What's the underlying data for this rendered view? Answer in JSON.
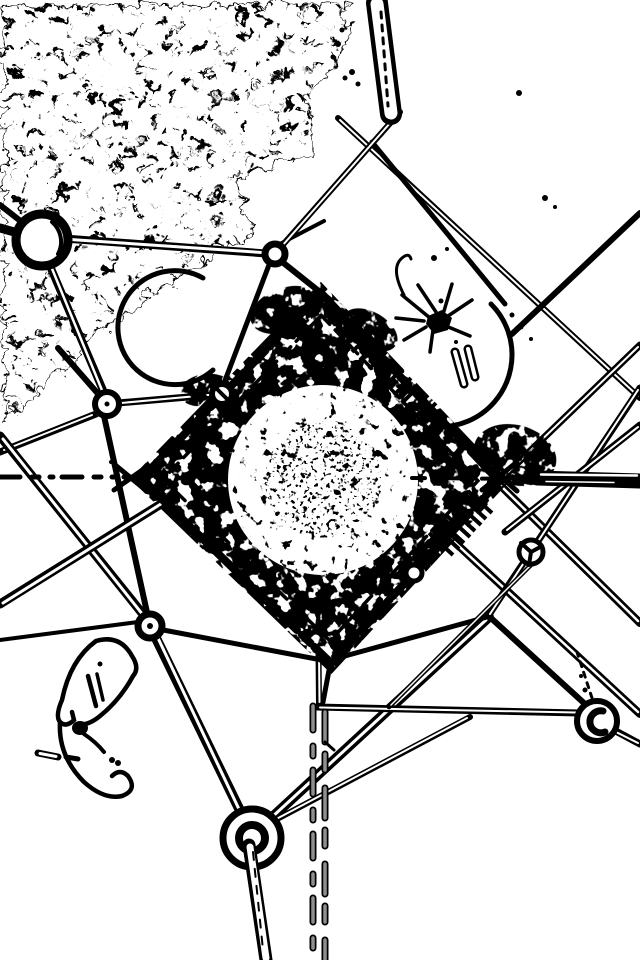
{
  "palette": {
    "paper": "#ffffff",
    "ink": "#000000",
    "soft_ink": "#8f8f8f"
  },
  "image": {
    "aria_label": "Monochrome edge-detected photograph looking up through the inside of a steel lattice tower: girders with circular joint plates converge toward a dense noisy diamond of crisscrossing steel at the center; dense tree foliage rendered as black scribbled texture fills the upper-left corner; curved conductor arcs, insulator hardware and dashed guide lines cross the frame.",
    "regions": [
      {
        "id": "foliage",
        "label": "Dense foliage edge texture, upper left"
      },
      {
        "id": "girders",
        "label": "Steel lattice girders"
      },
      {
        "id": "central",
        "label": "Central converging lattice diamond"
      },
      {
        "id": "joints",
        "label": "Circular joint plates"
      },
      {
        "id": "arcs",
        "label": "Curved conductor arcs"
      },
      {
        "id": "insulator",
        "label": "Insulator hardware cluster"
      },
      {
        "id": "plant",
        "label": "Plant silhouette, lower left"
      },
      {
        "id": "rod",
        "label": "Vertical rod, top center"
      },
      {
        "id": "dashes",
        "label": "Dashed guide lines"
      }
    ]
  }
}
